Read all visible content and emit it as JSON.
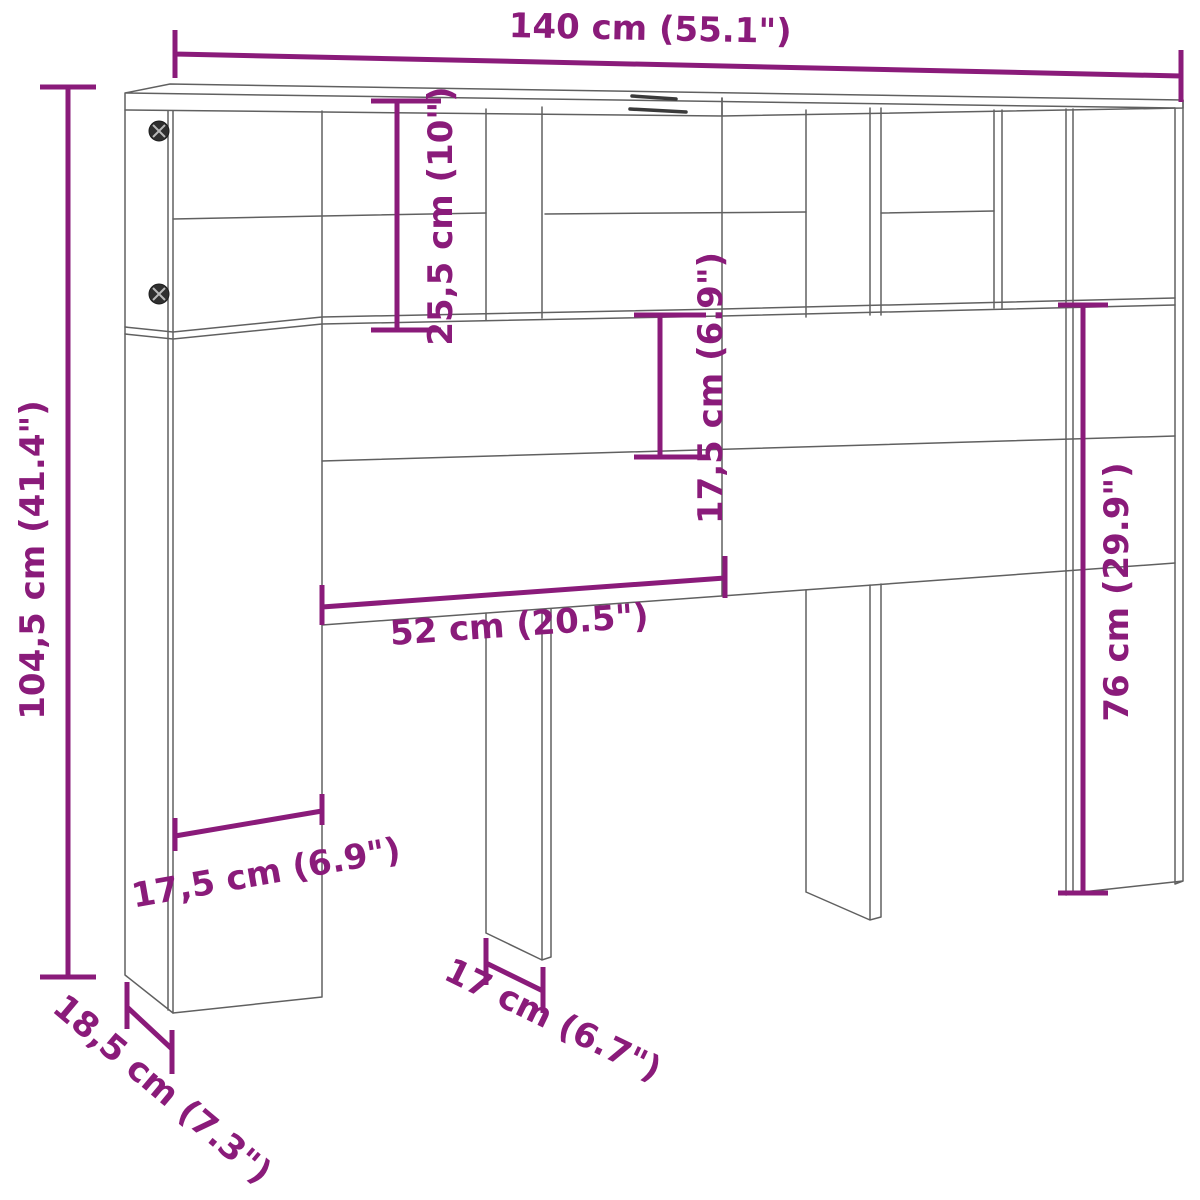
{
  "diagram": {
    "title": "headboard-cabinet-dimension-diagram",
    "type": "furniture-dimension-drawing",
    "colors": {
      "dimension_accent": "#8a1b7a",
      "outline": "#606060",
      "background": "#ffffff"
    },
    "dimensions": [
      {
        "name": "overall-width",
        "label": "140 cm (55.1\")"
      },
      {
        "name": "overall-height",
        "label": "104,5 cm (41.4\")"
      },
      {
        "name": "top-shelf-height",
        "label": "25,5 cm (10\")"
      },
      {
        "name": "back-rail-height",
        "label": "17,5 cm (6.9\")"
      },
      {
        "name": "leg-height",
        "label": "76 cm (29.9\")"
      },
      {
        "name": "back-panel-width",
        "label": "52 cm (20.5\")"
      },
      {
        "name": "side-column-width",
        "label": "17,5 cm (6.9\")"
      },
      {
        "name": "middle-leg-depth",
        "label": "17 cm (6.7\")"
      },
      {
        "name": "side-panel-depth",
        "label": "18,5 cm (7.3\")"
      }
    ]
  }
}
